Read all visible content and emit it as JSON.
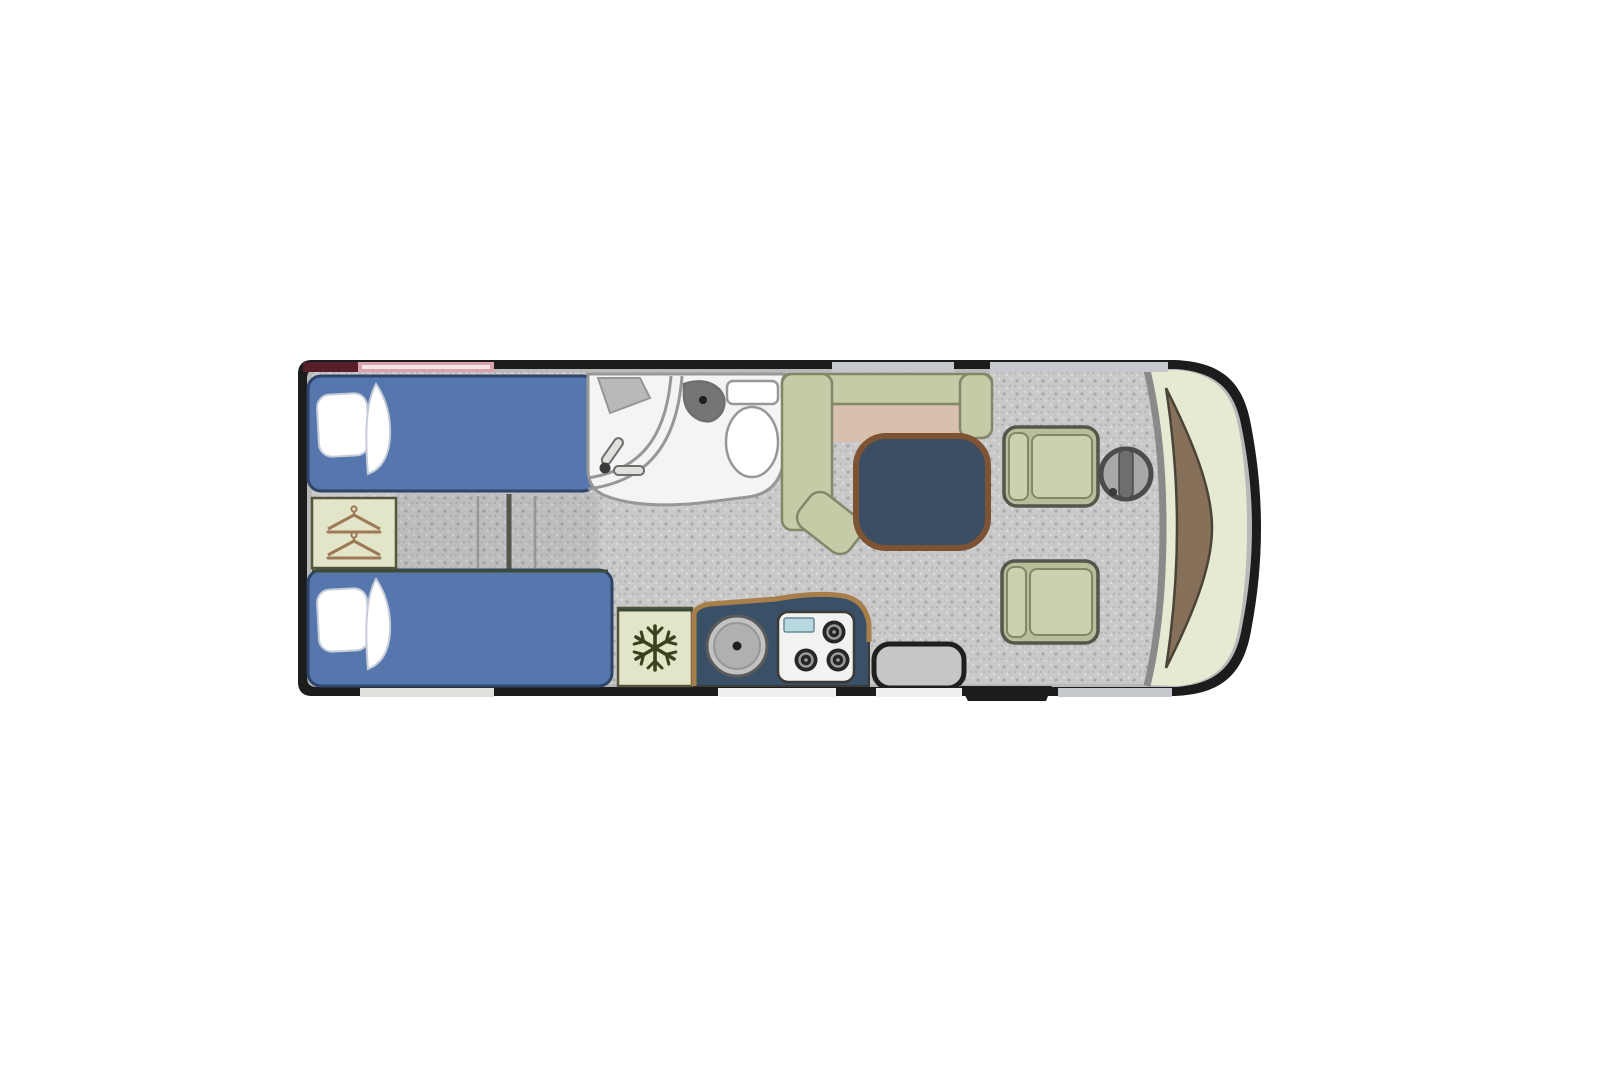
{
  "scene": {
    "type": "motorhome-floor-plan-top-view",
    "regions": [
      "rear-twin-single-bedroom",
      "central-washroom",
      "galley-kitchen",
      "half-dinette-lounge",
      "driving-cab",
      "entrance-door"
    ],
    "furniture": {
      "bedroom": [
        "single-bed-offside",
        "single-bed-nearside",
        "wardrobe-with-hangers",
        "between-bed-drawers"
      ],
      "washroom": [
        "shower-cubicle",
        "hand-basin",
        "toilet"
      ],
      "kitchen": [
        "refrigerator",
        "worktop",
        "round-sink",
        "three-burner-hob"
      ],
      "lounge": [
        "l-shaped-dinette-bench",
        "pedestal-table"
      ],
      "cab": [
        "driver-swivel-seat",
        "passenger-swivel-seat",
        "steering-wheel",
        "dashboard",
        "windscreen"
      ],
      "entrance": [
        "internal-step",
        "exterior-step",
        "door-opening"
      ]
    },
    "icons": [
      "hangers-icon",
      "snowflake-icon",
      "shower-head-icon"
    ]
  },
  "palette": {
    "page_bg": "#ffffff",
    "wall_black": "#1c1c1c",
    "shell_lining": "#b9b9b9",
    "floor_base": "#c9c9c9",
    "floor_speck_dark": "#a9a9a9",
    "floor_speck_mid": "#b9b9b9",
    "floor_speck_light": "#dedede",
    "corridor_shade": "rgba(80,92,104,0.10)",
    "bed_blue": "#5677ad",
    "bed_blue_dark": "#2e4469",
    "linen_white": "#ffffff",
    "linen_edge": "#c7cdd8",
    "cabinet_beige": "#e3e5c9",
    "cabinet_stroke": "#55553d",
    "hanger_brown": "#9c7a58",
    "bath_white": "#f4f4f2",
    "fixture_grey": "#979797",
    "fixture_dark": "#6e6e6e",
    "basin_dark": "#757575",
    "bench_sage": "#c6caa6",
    "bench_stroke": "#83876a",
    "cushion_pink": "#d9bfae",
    "table_navy": "#3a4d63",
    "table_edge_brown": "#7d5333",
    "seat_sage": "#ccd0ae",
    "seat_sage_mid": "#b9bd9a",
    "seat_border_dark": "#55554b",
    "counter_navy": "#3a5066",
    "counter_edge_tan": "#a87f4a",
    "stove_white": "#f2f2f0",
    "stove_stroke": "#3a3a3a",
    "burner_dark": "#262626",
    "burner_ring": "#9a9a9a",
    "drainer_blue": "#b8d9e2",
    "drainer_stroke": "#6a8a94",
    "sink_outer": "#c2c2c2",
    "sink_inner": "#b0b0b0",
    "sink_stroke": "#5a5a5a",
    "snowflake_green": "#39411f",
    "olive_line": "#3c4c34",
    "dash_brown": "#87705a",
    "dash_stroke": "#4a4438",
    "windscreen_green": "#e6ead2",
    "divider_grey": "#8a8a8a",
    "wheel_grey": "#a8a8a8",
    "wheel_dark": "#4c4c4c",
    "window_maroon": "#571f2a",
    "window_pink": "#d9a2ae",
    "window_pink_inner": "#f2e6e8",
    "window_grey": "#c5c9cd",
    "window_light": "#e0e0dd",
    "door_white": "#efefef",
    "step_grey": "#c6c6c6",
    "step_stroke": "#1f1f1f"
  }
}
